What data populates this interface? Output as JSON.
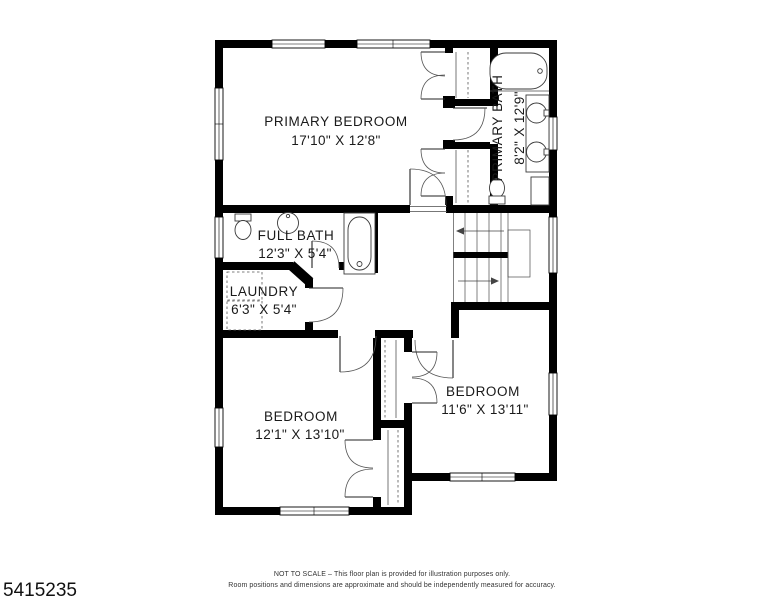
{
  "palette": {
    "background": "#ffffff",
    "walls": "#000000",
    "lines": "#444444",
    "text": "#1a1a1a"
  },
  "rooms": [
    {
      "name": "PRIMARY BEDROOM",
      "dims": "17'10\" X 12'8\""
    },
    {
      "name": "PRIMARY BATH",
      "dims": "8'2\" X 12'9\""
    },
    {
      "name": "FULL BATH",
      "dims": "12'3\" X 5'4\""
    },
    {
      "name": "LAUNDRY",
      "dims": "6'3\" X 5'4\""
    },
    {
      "name": "BEDROOM",
      "dims": "12'1\" X 13'10\""
    },
    {
      "name": "BEDROOM",
      "dims": "11'6\" X 13'11\""
    }
  ],
  "footer": {
    "line1": "NOT TO SCALE – This floor plan is provided for illustration purposes only.",
    "line2": "Room positions and dimensions are approximate and should be independently measured for accuracy.",
    "listing_id": "5415235"
  }
}
